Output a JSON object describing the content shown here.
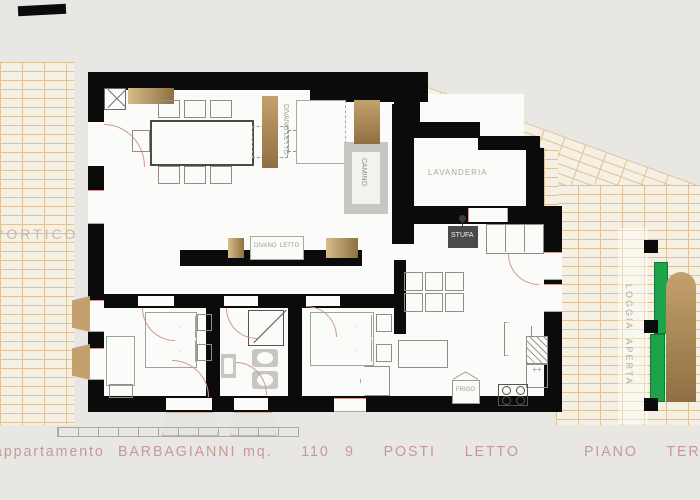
{
  "plan": {
    "rooms": {
      "portico": "PORTICO",
      "lavanderia": "LAVANDERIA",
      "loggia": "LOGGIA  APERTA",
      "legnaia": "LEGNAIA",
      "forno": "FORNO"
    },
    "fixtures": {
      "camino": "CAMINO",
      "stufa": "STUFA",
      "divano_letto": "DIVANO  LETTO",
      "divano_letto_vert": "DIVANO LETTO",
      "frigo": "FRIGO"
    },
    "caption": {
      "prefix": "appartamento",
      "name": "BARBAGIANNI",
      "size": "mq.  110",
      "beds": "9  POSTI  LETTO",
      "floor": "PIANO  TERRA"
    },
    "colors": {
      "wall": "#0b0b0b",
      "brick_face": "#f6f0e2",
      "brick_mortar": "#dcc29a",
      "wood": "#a9835a",
      "green_shutter": "#1ea24a",
      "caption_text": "#c49a96",
      "background": "#e9e7e3"
    }
  }
}
